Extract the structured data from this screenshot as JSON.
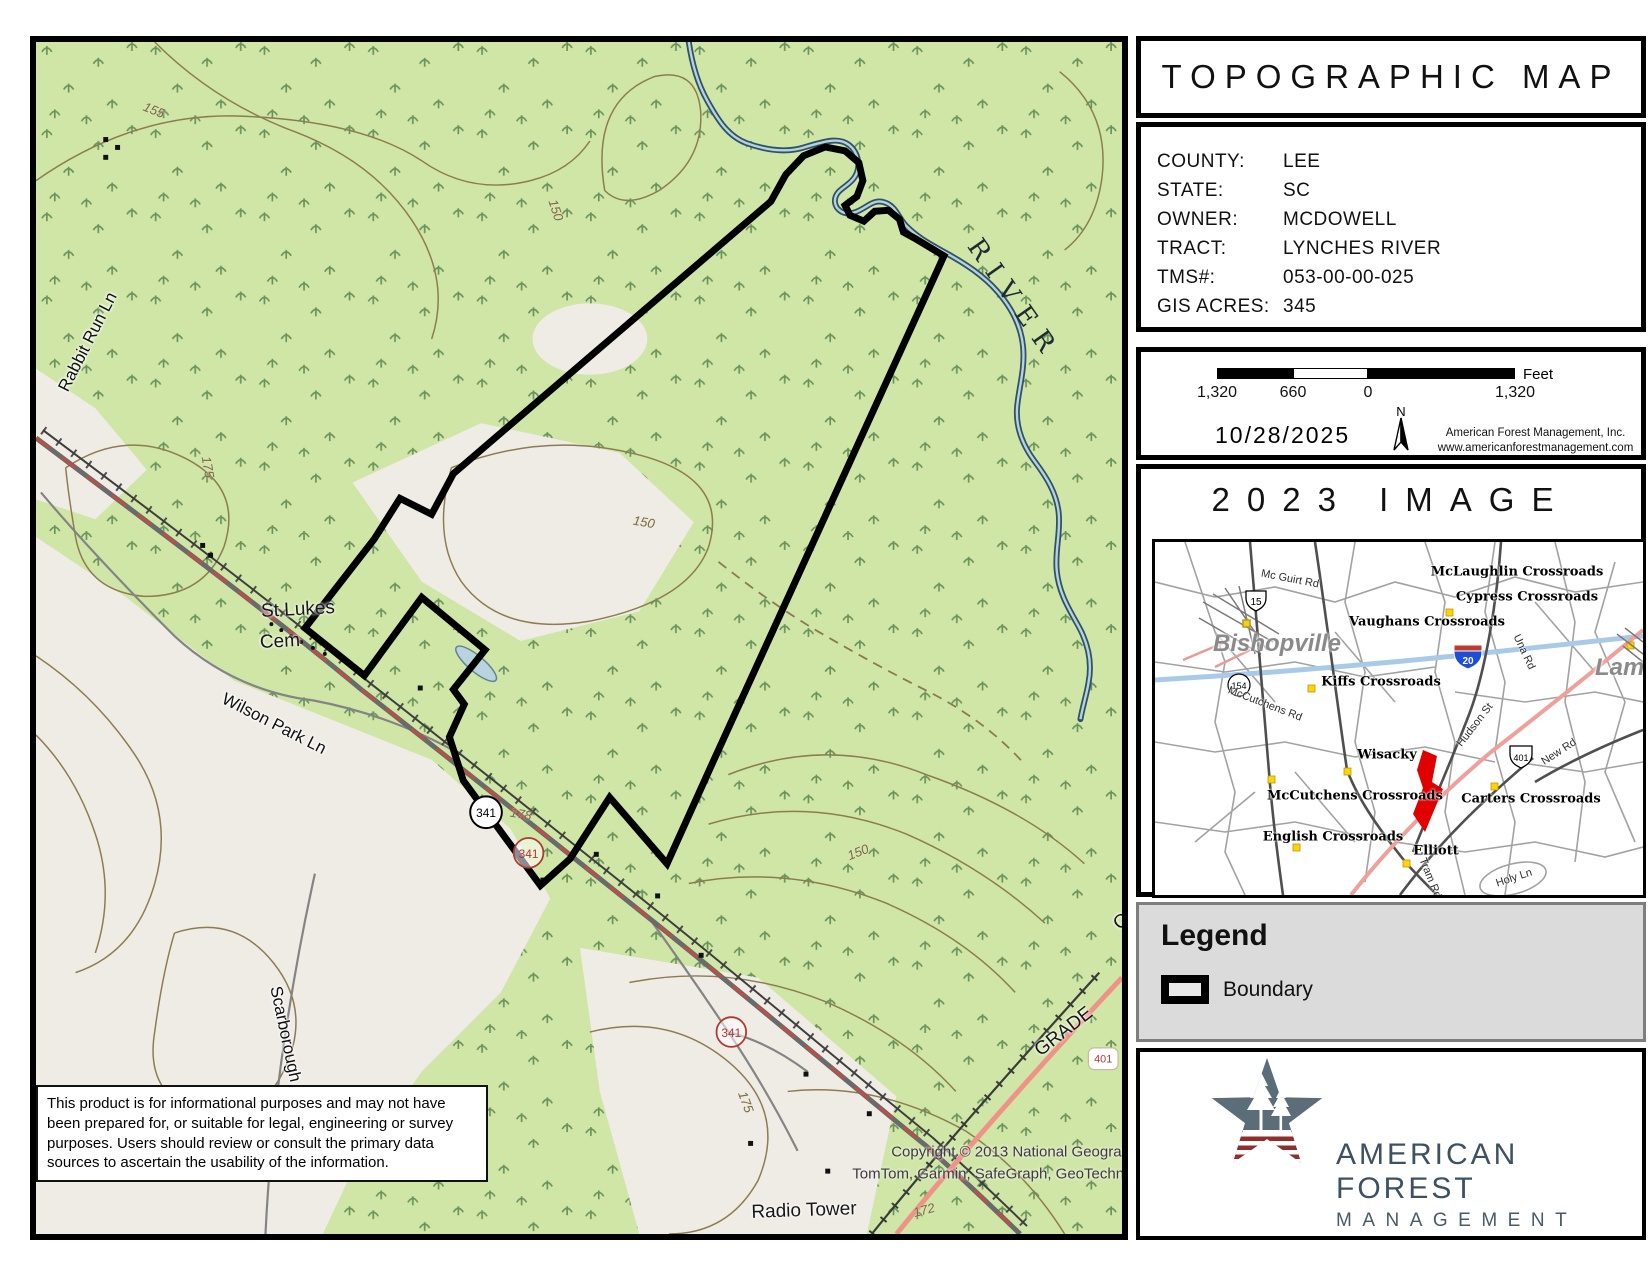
{
  "sidebar": {
    "title": "TOPOGRAPHIC MAP",
    "info": {
      "rows": [
        {
          "label": "COUNTY:",
          "value": "LEE"
        },
        {
          "label": "STATE:",
          "value": "SC"
        },
        {
          "label": "OWNER:",
          "value": "MCDOWELL"
        },
        {
          "label": "TRACT:",
          "value": "LYNCHES RIVER"
        },
        {
          "label": "TMS#:",
          "value": "053-00-00-025"
        },
        {
          "label": "GIS ACRES:",
          "value": "345"
        }
      ]
    },
    "scalebar": {
      "ticks": [
        "1,320",
        "660",
        "0",
        "1,320"
      ],
      "unit": "Feet"
    },
    "date": "10/28/2025",
    "north_label": "N",
    "company": [
      "American Forest Management, Inc.",
      "www.americanforestmanagement.com"
    ],
    "image_box_title": "2023 IMAGE",
    "legend": {
      "heading": "Legend",
      "items": [
        {
          "label": "Boundary"
        }
      ]
    },
    "logo": {
      "line1": "AMERICAN FOREST",
      "line2": "MANAGEMENT"
    }
  },
  "map": {
    "disclaimer": "This product is for informational purposes and may not have been prepared for, or suitable for legal, engineering or survey purposes.  Users should review or consult the primary data sources to ascertain the usability of the information.",
    "shields": [
      "341",
      "341",
      "341",
      "401"
    ],
    "colors": {
      "forest": "#cfe6a6",
      "open": "#efece6",
      "contour": "#8d7c50",
      "water": "#31506b",
      "road": "#6a6a6a",
      "red_road": "#ef9288",
      "boundary": "#000000",
      "shield_red": "#b03a30"
    },
    "labels": [
      {
        "t": "155",
        "x": 118,
        "y": 68,
        "r": 22,
        "c": "contour"
      },
      {
        "t": "150",
        "x": 520,
        "y": 168,
        "r": 72,
        "c": "contour"
      },
      {
        "t": "175",
        "x": 172,
        "y": 425,
        "r": 80,
        "c": "contour"
      },
      {
        "t": "150",
        "x": 608,
        "y": 480,
        "r": 10,
        "c": "contour"
      },
      {
        "t": "178",
        "x": 485,
        "y": 772,
        "r": 10,
        "c": "contour"
      },
      {
        "t": "150",
        "x": 822,
        "y": 810,
        "r": -22,
        "c": "contour"
      },
      {
        "t": "175",
        "x": 710,
        "y": 1060,
        "r": 70,
        "c": "contour"
      },
      {
        "t": "172",
        "x": 888,
        "y": 1168,
        "r": -15,
        "c": "contour"
      },
      {
        "t": "RIVER",
        "x": 978,
        "y": 258,
        "r": 55,
        "c": "river-label"
      },
      {
        "t": "St Lukes",
        "x": 262,
        "y": 568,
        "r": -3,
        "c": "place"
      },
      {
        "t": "Cem",
        "x": 244,
        "y": 600,
        "r": -3,
        "c": "place"
      },
      {
        "t": "Wilson Park Ln",
        "x": 238,
        "y": 682,
        "r": 27,
        "c": "road-label"
      },
      {
        "t": "Rabbit Run Ln",
        "x": 52,
        "y": 300,
        "r": -63,
        "c": "road-label"
      },
      {
        "t": "Scarborough Rd",
        "x": 252,
        "y": 1005,
        "r": 78,
        "c": "road-label"
      },
      {
        "t": "Radio Tower",
        "x": 768,
        "y": 1169,
        "r": -2,
        "c": "place"
      },
      {
        "t": "GRADE",
        "x": 1028,
        "y": 990,
        "r": -38,
        "c": "place"
      },
      {
        "t": "O",
        "x": 1086,
        "y": 880,
        "r": -38,
        "c": "place"
      },
      {
        "t": "Copyright © 2013 National Geographic Socie",
        "x": 1005,
        "y": 1110,
        "r": 0,
        "c": "copyright"
      },
      {
        "t": "TomTom, Garmin, SafeGraph, GeoTechnologies,",
        "x": 978,
        "y": 1132,
        "r": 0,
        "c": "copyright"
      }
    ]
  },
  "inset": {
    "shields": [
      "15",
      "154",
      "20",
      "401"
    ],
    "labels": [
      {
        "t": "McLaughlin Crossroads",
        "x": 362,
        "y": 30,
        "r": 0,
        "c": "xroad"
      },
      {
        "t": "Cypress Crossroads",
        "x": 372,
        "y": 55,
        "r": 0,
        "c": "xroad"
      },
      {
        "t": "Vaughans Crossroads",
        "x": 272,
        "y": 80,
        "r": 0,
        "c": "xroad"
      },
      {
        "t": "Kiffs Crossroads",
        "x": 226,
        "y": 140,
        "r": 0,
        "c": "xroad"
      },
      {
        "t": "Wisacky",
        "x": 232,
        "y": 213,
        "r": 0,
        "c": "xroad"
      },
      {
        "t": "McCutchens Crossroads",
        "x": 200,
        "y": 254,
        "r": 0,
        "c": "xroad"
      },
      {
        "t": "Carters Crossroads",
        "x": 376,
        "y": 257,
        "r": 0,
        "c": "xroad"
      },
      {
        "t": "English Crossroads",
        "x": 178,
        "y": 295,
        "r": 0,
        "c": "xroad"
      },
      {
        "t": "Elliott",
        "x": 281,
        "y": 309,
        "r": 0,
        "c": "xroad"
      },
      {
        "t": "Bishopville",
        "x": 122,
        "y": 102,
        "r": 0,
        "c": "town"
      },
      {
        "t": "Lamar",
        "x": 476,
        "y": 126,
        "r": 0,
        "c": "town"
      },
      {
        "t": "Mc Guirt Rd",
        "x": 135,
        "y": 37,
        "r": 11,
        "c": "iroad"
      },
      {
        "t": "McCutchens Rd",
        "x": 110,
        "y": 162,
        "r": 21,
        "c": "iroad"
      },
      {
        "t": "Una Rd",
        "x": 369,
        "y": 110,
        "r": 65,
        "c": "iroad"
      },
      {
        "t": "Hudson St",
        "x": 320,
        "y": 183,
        "r": -52,
        "c": "iroad"
      },
      {
        "t": "New Rd",
        "x": 404,
        "y": 210,
        "r": -33,
        "c": "iroad"
      },
      {
        "t": "Tram Rd",
        "x": 275,
        "y": 336,
        "r": 68,
        "c": "iroad"
      },
      {
        "t": "Holy Ln",
        "x": 359,
        "y": 336,
        "r": -18,
        "c": "iroad"
      }
    ]
  }
}
